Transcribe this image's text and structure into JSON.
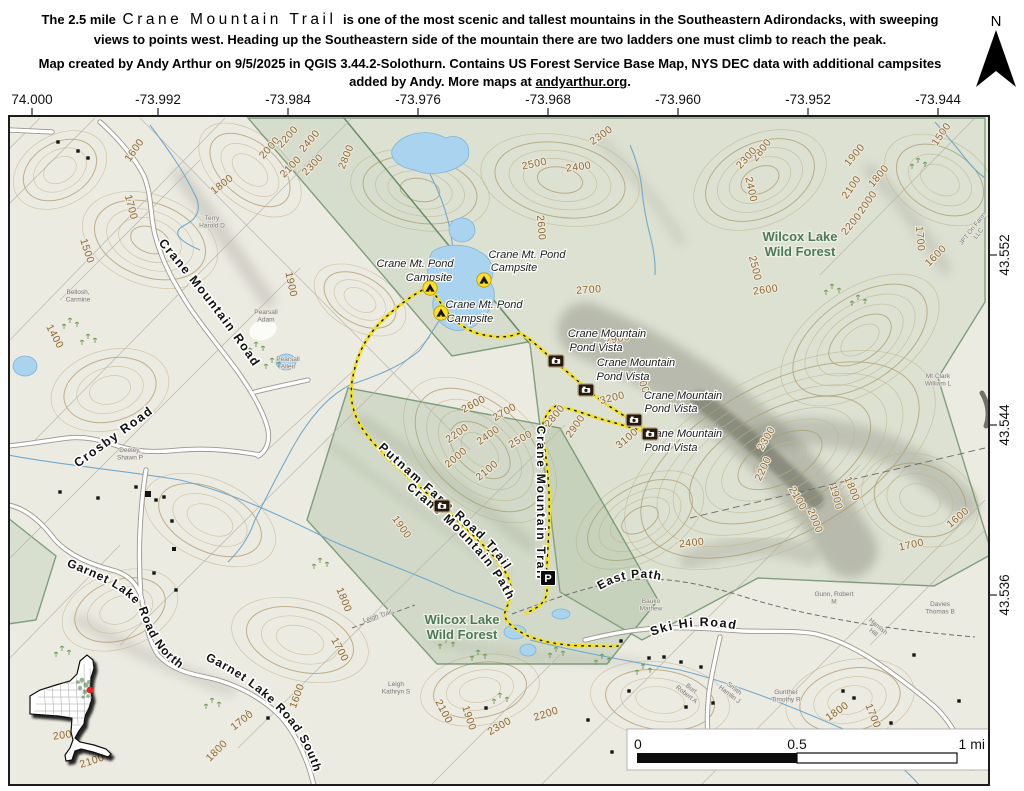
{
  "header": {
    "intro_prefix": "The 2.5 mile",
    "trail_name": "Crane Mountain Trail",
    "intro_suffix": "is one of the most scenic and tallest mountains in the Southeastern Adirondacks, with sweeping views to points west. Heading up the Southeastern side of the mountain there are two ladders one must climb to reach the peak.",
    "credit_before_link": "Map created by Andy Arthur on 9/5/2025 in QGIS 3.44.2-Solothurn. Contains US Forest Service Base Map, NYS DEC data with additional campsites added by Andy. More maps at ",
    "credit_link": "andyarthur.org",
    "credit_after_link": ".",
    "north_label": "N"
  },
  "axes": {
    "lon": [
      {
        "t": "74.000",
        "x": 32
      },
      {
        "t": "-73.992",
        "x": 158
      },
      {
        "t": "-73.984",
        "x": 288
      },
      {
        "t": "-73.976",
        "x": 418
      },
      {
        "t": "-73.968",
        "x": 548
      },
      {
        "t": "-73.960",
        "x": 678
      },
      {
        "t": "-73.952",
        "x": 808
      },
      {
        "t": "-73.944",
        "x": 938
      }
    ],
    "lat": [
      {
        "t": "43.552",
        "y": 255
      },
      {
        "t": "43.544",
        "y": 425
      },
      {
        "t": "43.536",
        "y": 595
      }
    ]
  },
  "scalebar": {
    "zero": "0",
    "half": "0.5",
    "one": "1 mi"
  },
  "colors": {
    "trail_yellow": "#f0df33",
    "water_blue": "#a9d3ee",
    "state_land_green": "#8fae85",
    "contour_brown": "#8f6b2e",
    "area_label_green": "#4c7a57",
    "campsite_yellow": "#ffdf2b",
    "locator_dot_red": "#e8221c",
    "map_background": "#ecebe2"
  },
  "map": {
    "curved_labels": {
      "cmr": "Crane Mountain Road",
      "garnet_n": "Garnet Lake Road North",
      "garnet_s": "Garnet Lake Road South",
      "putnam": "Putnam Farm Road Trail",
      "cmpath": "Crane Mountain Path",
      "skihi": "Ski Hi Road",
      "eastpath": "East Path"
    },
    "place_labels": [
      {
        "t": "Crosby Road",
        "x": 116,
        "y": 440,
        "r": -36,
        "cls": "road"
      },
      {
        "t": "Crane Mountain Trail",
        "x": 537,
        "y": 503,
        "r": 90,
        "cls": "trail"
      },
      {
        "t": "Wilcox Lake",
        "x": 800,
        "y": 241,
        "cls": "area"
      },
      {
        "t": "Wild Forest",
        "x": 800,
        "y": 256,
        "cls": "area"
      },
      {
        "t": "Wilcox Lake",
        "x": 462,
        "y": 624,
        "cls": "area"
      },
      {
        "t": "Wild Forest",
        "x": 462,
        "y": 639,
        "cls": "area"
      },
      {
        "t": "Crane Mt. Pond",
        "x": 415,
        "y": 267,
        "cls": "poi"
      },
      {
        "t": "Campsite",
        "x": 429,
        "y": 281,
        "cls": "poi"
      },
      {
        "t": "Crane Mt. Pond",
        "x": 527,
        "y": 258,
        "cls": "poi"
      },
      {
        "t": "Campsite",
        "x": 514,
        "y": 271,
        "cls": "poi"
      },
      {
        "t": "Crane Mt. Pond",
        "x": 484,
        "y": 308,
        "cls": "poi"
      },
      {
        "t": "Campsite",
        "x": 470,
        "y": 322,
        "cls": "poi"
      },
      {
        "t": "Crane Mountain",
        "x": 607,
        "y": 337,
        "cls": "poi"
      },
      {
        "t": "Pond Vista",
        "x": 596,
        "y": 351,
        "cls": "poi"
      },
      {
        "t": "Crane Mountain",
        "x": 636,
        "y": 366,
        "cls": "poi"
      },
      {
        "t": "Pond Vista",
        "x": 623,
        "y": 380,
        "cls": "poi"
      },
      {
        "t": "Crane Mountain",
        "x": 683,
        "y": 399,
        "cls": "poi"
      },
      {
        "t": "Pond Vista",
        "x": 671,
        "y": 412,
        "cls": "poi"
      },
      {
        "t": "Crane Mountain",
        "x": 683,
        "y": 437,
        "cls": "poi"
      },
      {
        "t": "Pond Vista",
        "x": 671,
        "y": 451,
        "cls": "poi"
      }
    ],
    "contour_labels": [
      {
        "t": "1600",
        "x": 137,
        "y": 152,
        "r": -55
      },
      {
        "t": "1800",
        "x": 224,
        "y": 187,
        "r": -38
      },
      {
        "t": "1700",
        "x": 128,
        "y": 208,
        "r": 75
      },
      {
        "t": "1500",
        "x": 84,
        "y": 252,
        "r": 72
      },
      {
        "t": "1400",
        "x": 52,
        "y": 338,
        "r": 62
      },
      {
        "t": "1900",
        "x": 288,
        "y": 285,
        "r": 78
      },
      {
        "t": "2000",
        "x": 272,
        "y": 150,
        "r": -48
      },
      {
        "t": "2200",
        "x": 290,
        "y": 139,
        "r": -48
      },
      {
        "t": "2400",
        "x": 312,
        "y": 143,
        "r": -50
      },
      {
        "t": "2100",
        "x": 293,
        "y": 169,
        "r": -46
      },
      {
        "t": "2300",
        "x": 315,
        "y": 167,
        "r": -46
      },
      {
        "t": "2800",
        "x": 349,
        "y": 158,
        "r": -68
      },
      {
        "t": "2500",
        "x": 535,
        "y": 167,
        "r": -12
      },
      {
        "t": "2400",
        "x": 579,
        "y": 170,
        "r": -8
      },
      {
        "t": "2300",
        "x": 603,
        "y": 138,
        "r": -35
      },
      {
        "t": "2600",
        "x": 538,
        "y": 228,
        "r": 85
      },
      {
        "t": "2700",
        "x": 589,
        "y": 293,
        "r": -4
      },
      {
        "t": "2800",
        "x": 764,
        "y": 152,
        "r": -52
      },
      {
        "t": "2300",
        "x": 749,
        "y": 160,
        "r": -48
      },
      {
        "t": "1900",
        "x": 857,
        "y": 157,
        "r": -50
      },
      {
        "t": "1800",
        "x": 881,
        "y": 178,
        "r": -50
      },
      {
        "t": "2100",
        "x": 854,
        "y": 189,
        "r": -55
      },
      {
        "t": "2000",
        "x": 870,
        "y": 204,
        "r": -55
      },
      {
        "t": "2200",
        "x": 854,
        "y": 226,
        "r": -50
      },
      {
        "t": "2400",
        "x": 748,
        "y": 190,
        "r": 78
      },
      {
        "t": "1500",
        "x": 944,
        "y": 136,
        "r": -55
      },
      {
        "t": "1700",
        "x": 917,
        "y": 239,
        "r": 85
      },
      {
        "t": "1600",
        "x": 938,
        "y": 258,
        "r": -45
      },
      {
        "t": "2500",
        "x": 752,
        "y": 269,
        "r": 76
      },
      {
        "t": "2600",
        "x": 766,
        "y": 293,
        "r": -8
      },
      {
        "t": "2900",
        "x": 618,
        "y": 342,
        "r": -10
      },
      {
        "t": "3200",
        "x": 613,
        "y": 401,
        "r": -14
      },
      {
        "t": "3000",
        "x": 641,
        "y": 388,
        "r": 70
      },
      {
        "t": "3100",
        "x": 629,
        "y": 441,
        "r": -40
      },
      {
        "t": "2800",
        "x": 557,
        "y": 418,
        "r": -50
      },
      {
        "t": "2900",
        "x": 578,
        "y": 428,
        "r": -55
      },
      {
        "t": "2600",
        "x": 475,
        "y": 407,
        "r": -28
      },
      {
        "t": "2700",
        "x": 506,
        "y": 415,
        "r": -30
      },
      {
        "t": "2200",
        "x": 459,
        "y": 436,
        "r": -35
      },
      {
        "t": "2400",
        "x": 490,
        "y": 438,
        "r": -35
      },
      {
        "t": "2500",
        "x": 522,
        "y": 442,
        "r": -30
      },
      {
        "t": "2000",
        "x": 458,
        "y": 460,
        "r": -40
      },
      {
        "t": "2100",
        "x": 489,
        "y": 473,
        "r": -40
      },
      {
        "t": "1900",
        "x": 399,
        "y": 529,
        "r": 55
      },
      {
        "t": "1800",
        "x": 341,
        "y": 601,
        "r": 68
      },
      {
        "t": "1700",
        "x": 337,
        "y": 651,
        "r": 62
      },
      {
        "t": "2400",
        "x": 692,
        "y": 546,
        "r": -6
      },
      {
        "t": "1900",
        "x": 466,
        "y": 719,
        "r": 72
      },
      {
        "t": "2100",
        "x": 441,
        "y": 713,
        "r": 62
      },
      {
        "t": "2300",
        "x": 501,
        "y": 729,
        "r": -30
      },
      {
        "t": "2200",
        "x": 547,
        "y": 717,
        "r": -18
      },
      {
        "t": "2000",
        "x": 66,
        "y": 738,
        "r": -8
      },
      {
        "t": "2100",
        "x": 93,
        "y": 764,
        "r": -18
      },
      {
        "t": "1700",
        "x": 244,
        "y": 723,
        "r": -38
      },
      {
        "t": "1800",
        "x": 219,
        "y": 753,
        "r": -45
      },
      {
        "t": "1600",
        "x": 300,
        "y": 697,
        "r": -70
      },
      {
        "t": "1800",
        "x": 839,
        "y": 714,
        "r": -35
      },
      {
        "t": "1700",
        "x": 870,
        "y": 717,
        "r": 68
      },
      {
        "t": "2300",
        "x": 769,
        "y": 440,
        "r": -60
      },
      {
        "t": "2200",
        "x": 766,
        "y": 470,
        "r": -65
      },
      {
        "t": "2100",
        "x": 795,
        "y": 500,
        "r": 60
      },
      {
        "t": "1900",
        "x": 833,
        "y": 498,
        "r": 75
      },
      {
        "t": "1800",
        "x": 849,
        "y": 490,
        "r": 68
      },
      {
        "t": "2000",
        "x": 812,
        "y": 522,
        "r": 68
      },
      {
        "t": "1600",
        "x": 960,
        "y": 520,
        "r": -40
      },
      {
        "t": "1700",
        "x": 912,
        "y": 548,
        "r": -12
      }
    ],
    "parcel_labels": [
      {
        "t": "Terry\nHarold D",
        "x": 212,
        "y": 220
      },
      {
        "t": "Bellosh,\nCarmine",
        "x": 78,
        "y": 294
      },
      {
        "t": "Pearsall\nAdam",
        "x": 266,
        "y": 314
      },
      {
        "t": "Pearsall\nAllen",
        "x": 288,
        "y": 361
      },
      {
        "t": "Deeley,\nShawn P",
        "x": 130,
        "y": 452
      },
      {
        "t": "Leigh Trail",
        "x": 378,
        "y": 618,
        "r": -18
      },
      {
        "t": "Leigh\nKathryn S",
        "x": 396,
        "y": 686
      },
      {
        "t": "Bauko\nMathew",
        "x": 651,
        "y": 603
      },
      {
        "t": "Gunn, Robert\nM",
        "x": 834,
        "y": 596
      },
      {
        "t": "Davies\nThomas B",
        "x": 940,
        "y": 606
      },
      {
        "t": "Burt\nRobert A",
        "x": 690,
        "y": 690,
        "r": 38
      },
      {
        "t": "Smith\nHamlin J",
        "x": 733,
        "y": 690,
        "r": 38
      },
      {
        "t": "Gunther\nTimothy R",
        "x": 786,
        "y": 694
      },
      {
        "t": "Hamish\nHill",
        "x": 877,
        "y": 628,
        "r": 40
      },
      {
        "t": "Mt Clark\nWilliam L",
        "x": 938,
        "y": 378
      },
      {
        "t": "JPT On Farm\nLLC",
        "x": 974,
        "y": 230,
        "r": -52
      }
    ],
    "markers": {
      "campsites": [
        [
          430,
          288
        ],
        [
          484,
          280
        ],
        [
          441,
          313
        ]
      ],
      "cameras": [
        [
          556,
          361
        ],
        [
          586,
          390
        ],
        [
          634,
          420
        ],
        [
          650,
          434
        ],
        [
          442,
          506
        ]
      ],
      "parking": [
        [
          548,
          578
        ]
      ],
      "parking_glyph": "P"
    },
    "buildings": [
      [
        58,
        142
      ],
      [
        78,
        151
      ],
      [
        88,
        158
      ],
      [
        60,
        492
      ],
      [
        98,
        498
      ],
      [
        136,
        487
      ],
      [
        148,
        494,
        6
      ],
      [
        156,
        500
      ],
      [
        164,
        497
      ],
      [
        172,
        521
      ],
      [
        174,
        549,
        4
      ],
      [
        154,
        573
      ],
      [
        176,
        590
      ],
      [
        621,
        641
      ],
      [
        649,
        658
      ],
      [
        664,
        657
      ],
      [
        681,
        662
      ],
      [
        701,
        667
      ],
      [
        686,
        707
      ],
      [
        713,
        703
      ],
      [
        843,
        691
      ],
      [
        854,
        698
      ],
      [
        891,
        723
      ],
      [
        904,
        757
      ],
      [
        914,
        655
      ],
      [
        959,
        701
      ],
      [
        969,
        758
      ],
      [
        629,
        691
      ],
      [
        268,
        718
      ],
      [
        247,
        712
      ],
      [
        486,
        708
      ],
      [
        588,
        720
      ],
      [
        612,
        752
      ],
      [
        660,
        740
      ]
    ],
    "veg": [
      [
        70,
        320
      ],
      [
        88,
        336
      ],
      [
        256,
        344
      ],
      [
        272,
        360
      ],
      [
        62,
        648
      ],
      [
        446,
        640
      ],
      [
        478,
        652
      ],
      [
        556,
        649
      ],
      [
        602,
        656
      ],
      [
        832,
        286
      ],
      [
        858,
        297
      ],
      [
        212,
        700
      ],
      [
        643,
        666
      ],
      [
        918,
        160
      ],
      [
        500,
        695
      ],
      [
        320,
        560
      ]
    ]
  }
}
